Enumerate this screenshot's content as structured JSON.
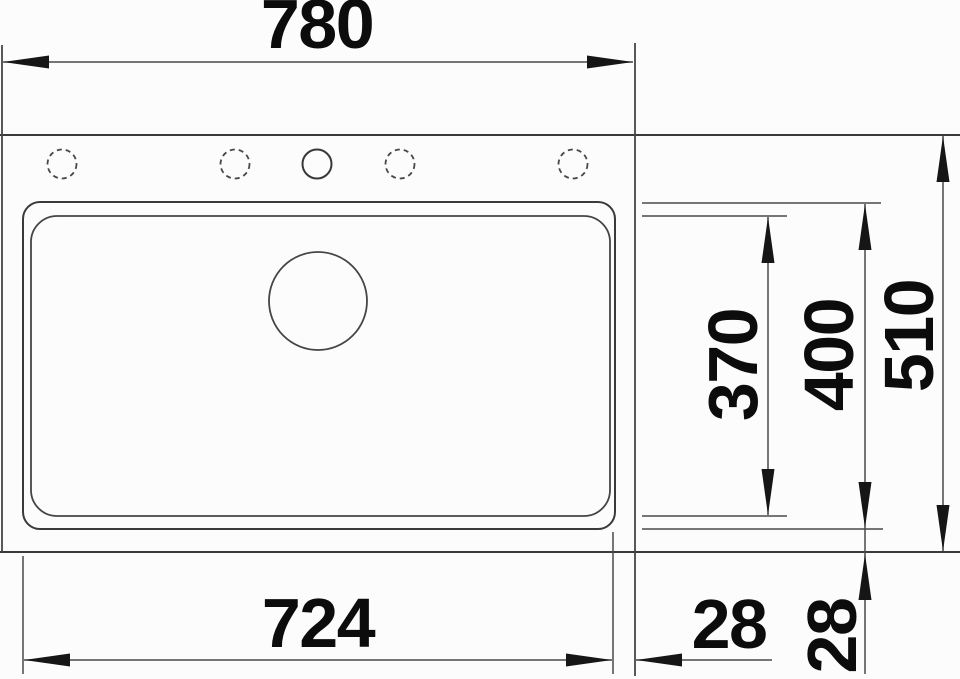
{
  "drawing": {
    "type": "technical-dimension-drawing",
    "subject": "kitchen sink top view with installation dimensions (mm)",
    "background_color": "#fcfcfc",
    "line_color": "#3a3a3a",
    "text_color": "#0c0c0c",
    "units": "mm"
  },
  "dims": {
    "overall_width": "780",
    "overall_depth": "510",
    "bowl_outer_depth": "400",
    "bowl_inner_depth": "370",
    "bowl_width": "724",
    "right_offset": "28",
    "bottom_offset": "28"
  }
}
